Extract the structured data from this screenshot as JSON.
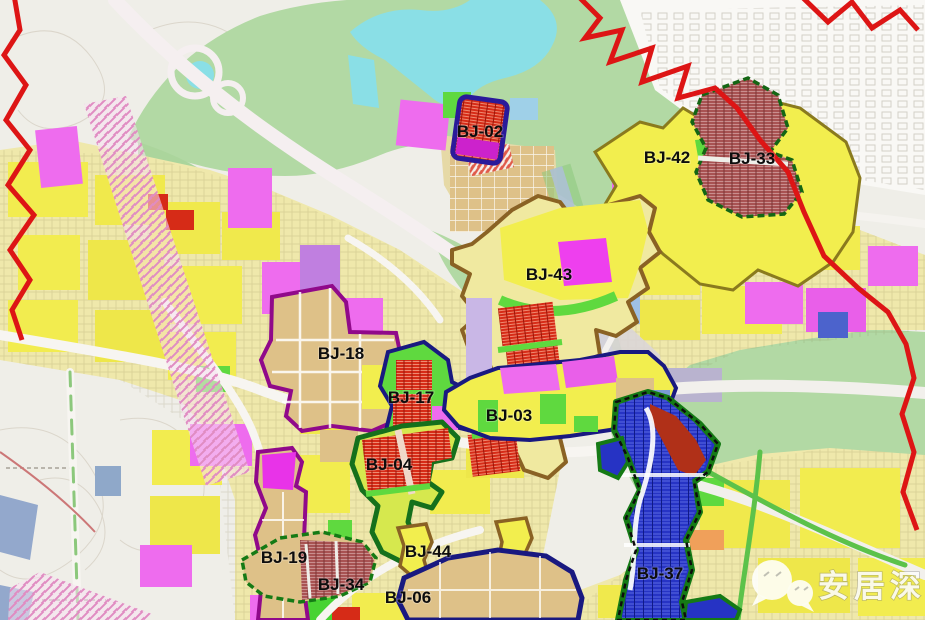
{
  "map": {
    "kind": "urban-planning-zoning-map",
    "zones": [
      {
        "id": "BJ-02",
        "label": "BJ-02",
        "label_x": 480,
        "label_y": 131
      },
      {
        "id": "BJ-42",
        "label": "BJ-42",
        "label_x": 667,
        "label_y": 157
      },
      {
        "id": "BJ-33",
        "label": "BJ-33",
        "label_x": 752,
        "label_y": 158
      },
      {
        "id": "BJ-43",
        "label": "BJ-43",
        "label_x": 549,
        "label_y": 274
      },
      {
        "id": "BJ-18",
        "label": "BJ-18",
        "label_x": 341,
        "label_y": 353
      },
      {
        "id": "BJ-17",
        "label": "BJ-17",
        "label_x": 411,
        "label_y": 397
      },
      {
        "id": "BJ-03",
        "label": "BJ-03",
        "label_x": 509,
        "label_y": 415
      },
      {
        "id": "BJ-04",
        "label": "BJ-04",
        "label_x": 389,
        "label_y": 464
      },
      {
        "id": "BJ-19",
        "label": "BJ-19",
        "label_x": 284,
        "label_y": 557
      },
      {
        "id": "BJ-34",
        "label": "BJ-34",
        "label_x": 341,
        "label_y": 584
      },
      {
        "id": "BJ-44",
        "label": "BJ-44",
        "label_x": 428,
        "label_y": 551
      },
      {
        "id": "BJ-06",
        "label": "BJ-06",
        "label_x": 408,
        "label_y": 597
      },
      {
        "id": "BJ-37",
        "label": "BJ-37",
        "label_x": 660,
        "label_y": 573
      }
    ],
    "watermark": {
      "text": "安居深圳",
      "icon": "wechat-bubbles-icon"
    },
    "palette": {
      "boundary_red": "#dd1515",
      "yellow_parcel": "#f2ec4f",
      "magenta_parcel": "#ee6cee",
      "tan_parcel": "#dec188",
      "vegetation_green": "#b2d9a4",
      "bright_green": "#5fd93f",
      "water_cyan": "#8adfe6",
      "red_block": "#d62b17",
      "maroon_hatch": "#a85252",
      "blue_zone": "#2633c4",
      "navy_outline": "#191980",
      "purple_outline": "#90098a",
      "green_outline": "#157a15",
      "brown_outline": "#8a6224",
      "label_color": "#0d0d0d"
    }
  }
}
